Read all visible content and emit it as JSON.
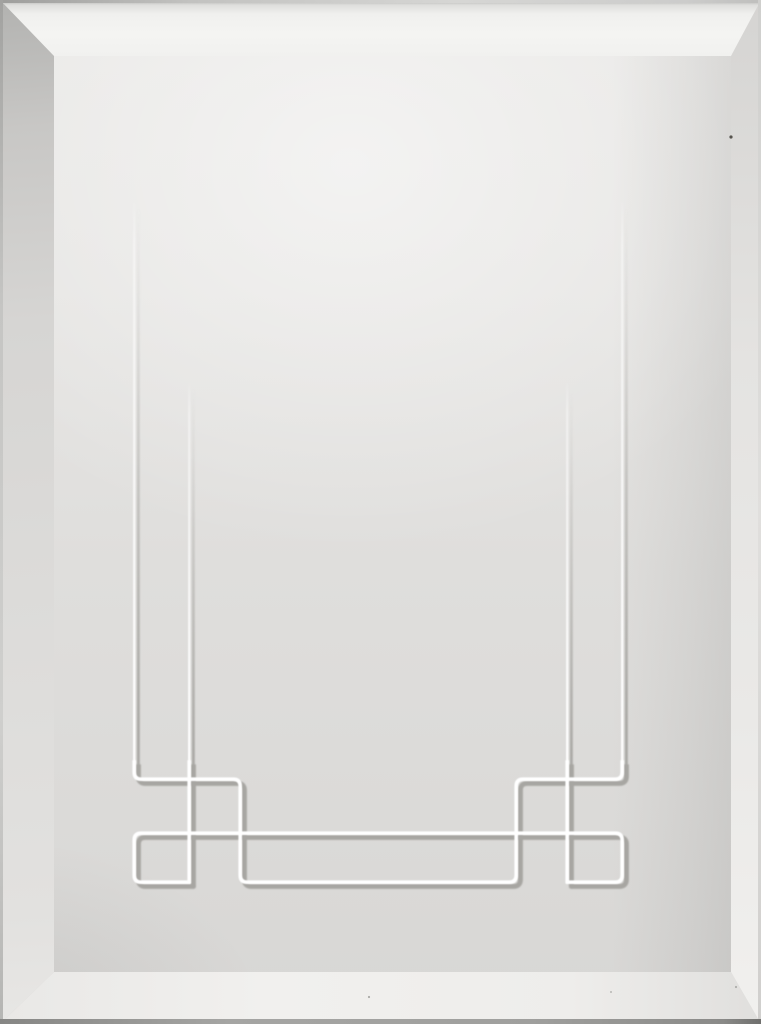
{
  "scene": {
    "type": "product-photo",
    "subject": "white beveled cabinet door panel with engraved prairie-style geometric line pattern",
    "text_content": "none"
  },
  "door": {
    "width": 761,
    "height": 1024,
    "bevel_widths": {
      "top": 56,
      "left": 54,
      "right": 30,
      "bottom": 52
    }
  },
  "colors": {
    "face_base": "#dfdedc",
    "face_top": "#e9e8e6",
    "face_bottom": "#d8d7d5",
    "bevel_top": "#f4f4f2",
    "bevel_left": "#d6d5d3",
    "bevel_right": "#e4e3e1",
    "bevel_bottom": "#eeedeb",
    "edge_dark": "#8e8e8c",
    "groove_highlight": "#ffffff",
    "groove_shadow": "#a7a6a2",
    "dust": "#56544e"
  },
  "pattern": {
    "viewbox": "0 0 761 1024",
    "description": "engraved V-groove lines: two tapered verticals per side descending into interlocked squares and a long bottom rectangle",
    "line_centers": {
      "verticals_x": [
        136,
        191,
        242,
        518,
        569,
        624
      ],
      "horizontals_y": [
        781,
        835,
        884
      ],
      "outer_line_top_y": 205,
      "inner_line_top_y": 386
    },
    "corner_radius": 7,
    "shadow_offset": 2.4,
    "highlight_offset": -1.8,
    "widths": {
      "thin_highlight": 2.2,
      "thin_shadow": 2.8,
      "thick_highlight": 3.6,
      "thick_shadow": 5.0
    },
    "clip_low": {
      "x": 90,
      "y": 762,
      "w": 580,
      "h": 140
    },
    "paths": [
      {
        "name": "outer-staple",
        "d": "M 136 205 L 136 774 Q 136 781 143 781 L 235 781 Q 242 781 242 788 L 242 877 Q 242 884 249 884 L 511 884 Q 518 884 518 877 L 518 788 Q 518 781 525 781 L 617 781 Q 624 781 624 774 L 624 205",
        "fade": "outer"
      },
      {
        "name": "band-with-hooks",
        "d": "M 191 884 L 143 884 Q 136 884 136 877 L 136 842 Q 136 835 143 835 L 617 835 Q 624 835 624 842 L 624 877 Q 624 884 617 884 L 569 884",
        "fade": null
      },
      {
        "name": "left-inner-vertical",
        "d": "M 191 386 L 191 884",
        "fade": "inner"
      },
      {
        "name": "right-inner-vertical",
        "d": "M 569 386 L 569 884",
        "fade": "inner"
      }
    ],
    "fades": {
      "outer": {
        "from": 205,
        "to": 725
      },
      "inner": {
        "from": 386,
        "to": 755
      }
    }
  },
  "dust_specks": [
    {
      "x": 731,
      "y": 137,
      "r": 1.6,
      "color": "#56544e",
      "opacity": 1
    },
    {
      "x": 369,
      "y": 997,
      "r": 1.1,
      "color": "#9a9a96",
      "opacity": 0.8
    },
    {
      "x": 611,
      "y": 992,
      "r": 1.0,
      "color": "#a2a29e",
      "opacity": 0.7
    },
    {
      "x": 736,
      "y": 987,
      "r": 1.1,
      "color": "#9c9c98",
      "opacity": 0.75
    }
  ]
}
